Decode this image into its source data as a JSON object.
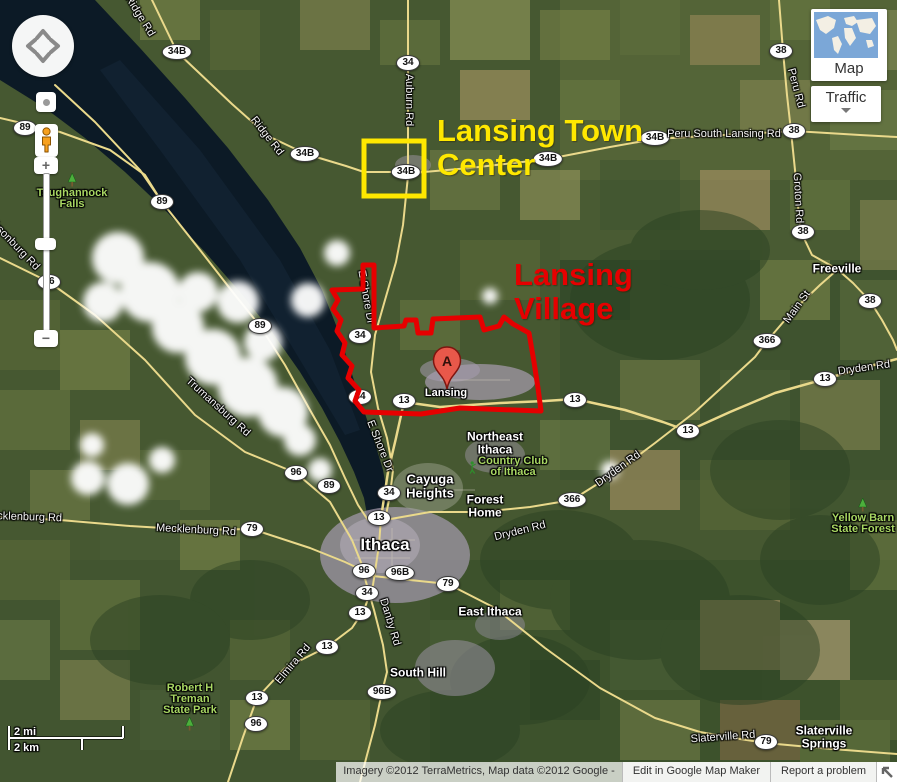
{
  "map_annotations": {
    "town_center": {
      "line1": "Lansing Town",
      "line2": "Center",
      "color": "#ffe800",
      "box": {
        "x": 364,
        "y": 141,
        "w": 60,
        "h": 55
      }
    },
    "village": {
      "line1": "Lansing",
      "line2": "Village",
      "color": "#e60000",
      "outline_points": "363,265 374,265 374,328 404,326 406,320 416,320 418,333 431,333 433,319 480,317 484,330 499,326 504,317 513,324 529,333 534,362 538,388 541,411 460,408 421,414 364,412 355,401 359,390 348,378 352,366 342,355 345,343 337,331 341,320 333,309 338,300 332,290 363,289"
    }
  },
  "marker": {
    "letter": "A"
  },
  "route_shields": [
    {
      "t": "34B",
      "x": 177,
      "y": 52
    },
    {
      "t": "34",
      "x": 408,
      "y": 63
    },
    {
      "t": "38",
      "x": 781,
      "y": 51
    },
    {
      "t": "34B",
      "x": 305,
      "y": 154
    },
    {
      "t": "34B",
      "x": 406,
      "y": 172
    },
    {
      "t": "34B",
      "x": 548,
      "y": 159
    },
    {
      "t": "34B",
      "x": 655,
      "y": 138
    },
    {
      "t": "38",
      "x": 794,
      "y": 131
    },
    {
      "t": "89",
      "x": 25,
      "y": 128
    },
    {
      "t": "89",
      "x": 162,
      "y": 202
    },
    {
      "t": "38",
      "x": 803,
      "y": 232
    },
    {
      "t": "89",
      "x": 260,
      "y": 326
    },
    {
      "t": "96",
      "x": 49,
      "y": 282
    },
    {
      "t": "34",
      "x": 360,
      "y": 336
    },
    {
      "t": "38",
      "x": 870,
      "y": 301
    },
    {
      "t": "366",
      "x": 767,
      "y": 341
    },
    {
      "t": "34",
      "x": 360,
      "y": 397
    },
    {
      "t": "13",
      "x": 404,
      "y": 401
    },
    {
      "t": "13",
      "x": 575,
      "y": 400
    },
    {
      "t": "13",
      "x": 688,
      "y": 431
    },
    {
      "t": "13",
      "x": 825,
      "y": 379
    },
    {
      "t": "96",
      "x": 296,
      "y": 473
    },
    {
      "t": "89",
      "x": 329,
      "y": 486
    },
    {
      "t": "34",
      "x": 389,
      "y": 493
    },
    {
      "t": "366",
      "x": 572,
      "y": 500
    },
    {
      "t": "13",
      "x": 379,
      "y": 518
    },
    {
      "t": "79",
      "x": 252,
      "y": 529
    },
    {
      "t": "96",
      "x": 364,
      "y": 571
    },
    {
      "t": "96B",
      "x": 400,
      "y": 573
    },
    {
      "t": "79",
      "x": 448,
      "y": 584
    },
    {
      "t": "34",
      "x": 367,
      "y": 593
    },
    {
      "t": "13",
      "x": 360,
      "y": 613
    },
    {
      "t": "13",
      "x": 327,
      "y": 647
    },
    {
      "t": "96B",
      "x": 382,
      "y": 692
    },
    {
      "t": "13",
      "x": 257,
      "y": 698
    },
    {
      "t": "96",
      "x": 256,
      "y": 724
    },
    {
      "t": "79",
      "x": 766,
      "y": 742
    }
  ],
  "road_labels": [
    {
      "t": "Ridge Rd",
      "x": 140,
      "y": 16,
      "r": 58
    },
    {
      "t": "Ridge Rd",
      "x": 267,
      "y": 136,
      "r": 52
    },
    {
      "t": "Auburn Rd",
      "x": 409,
      "y": 100,
      "r": 90
    },
    {
      "t": "Peru South Lansing Rd",
      "x": 724,
      "y": 134,
      "r": 0
    },
    {
      "t": "Peru Rd",
      "x": 796,
      "y": 88,
      "r": 75
    },
    {
      "t": "Groton Rd",
      "x": 798,
      "y": 198,
      "r": 87
    },
    {
      "t": "E Shore Dr",
      "x": 366,
      "y": 297,
      "r": 80
    },
    {
      "t": "E Shore Dr",
      "x": 380,
      "y": 446,
      "r": 68
    },
    {
      "t": "Jacksonburg Rd",
      "x": 10,
      "y": 240,
      "r": 46
    },
    {
      "t": "Trumansburg Rd",
      "x": 218,
      "y": 407,
      "r": 42
    },
    {
      "t": "Mecklenburg Rd",
      "x": 22,
      "y": 517,
      "r": 2
    },
    {
      "t": "Mecklenburg Rd",
      "x": 196,
      "y": 530,
      "r": 3
    },
    {
      "t": "Elmira Rd",
      "x": 293,
      "y": 664,
      "r": -50
    },
    {
      "t": "Danby Rd",
      "x": 390,
      "y": 622,
      "r": 73
    },
    {
      "t": "Dryden Rd",
      "x": 520,
      "y": 531,
      "r": -14
    },
    {
      "t": "Dryden Rd",
      "x": 618,
      "y": 469,
      "r": -36
    },
    {
      "t": "Dryden Rd",
      "x": 864,
      "y": 368,
      "r": -8
    },
    {
      "t": "Main St",
      "x": 797,
      "y": 307,
      "r": -54
    },
    {
      "t": "Slaterville Rd",
      "x": 723,
      "y": 737,
      "r": -4
    }
  ],
  "place_labels": [
    {
      "lines": [
        "Ithaca"
      ],
      "x": 385,
      "y": 545,
      "size": 17
    },
    {
      "lines": [
        "Cayuga",
        "Heights"
      ],
      "x": 430,
      "y": 486,
      "size": 13
    },
    {
      "lines": [
        "Northeast",
        "Ithaca"
      ],
      "x": 495,
      "y": 443,
      "size": 12
    },
    {
      "lines": [
        "Forest",
        "Home"
      ],
      "x": 485,
      "y": 506,
      "size": 12
    },
    {
      "lines": [
        "East Ithaca"
      ],
      "x": 490,
      "y": 612,
      "size": 12
    },
    {
      "lines": [
        "South Hill"
      ],
      "x": 418,
      "y": 673,
      "size": 12
    },
    {
      "lines": [
        "Freeville"
      ],
      "x": 837,
      "y": 269,
      "size": 12
    },
    {
      "lines": [
        "Slaterville",
        "Springs"
      ],
      "x": 824,
      "y": 737,
      "size": 12
    },
    {
      "lines": [
        "Lansing"
      ],
      "x": 446,
      "y": 394,
      "size": 11
    }
  ],
  "poi_labels": [
    {
      "lines": [
        "Taughannock",
        "Falls"
      ],
      "x": 72,
      "y": 172,
      "icon": "tree",
      "icon_pos": "above"
    },
    {
      "lines": [
        "Country Club",
        "of Ithaca"
      ],
      "x": 508,
      "y": 456,
      "icon": "golf",
      "icon_pos": "left"
    },
    {
      "lines": [
        "Robert H",
        "Treman",
        "State Park"
      ],
      "x": 190,
      "y": 683,
      "icon": "tree",
      "icon_pos": "below"
    },
    {
      "lines": [
        "Yellow Barn",
        "State Forest"
      ],
      "x": 863,
      "y": 497,
      "icon": "tree",
      "icon_pos": "above"
    }
  ],
  "controls": {
    "zoom_in": "+",
    "zoom_out": "−",
    "map_view_button": "Map",
    "traffic_button": "Traffic"
  },
  "scale_bar": {
    "miles": "2 mi",
    "km": "2 km"
  },
  "attribution": {
    "copyright": "Imagery ©2012 TerraMetrics, Map data ©2012 Google -",
    "edit_button": "Edit in Google Map Maker",
    "report_button": "Report a problem"
  }
}
